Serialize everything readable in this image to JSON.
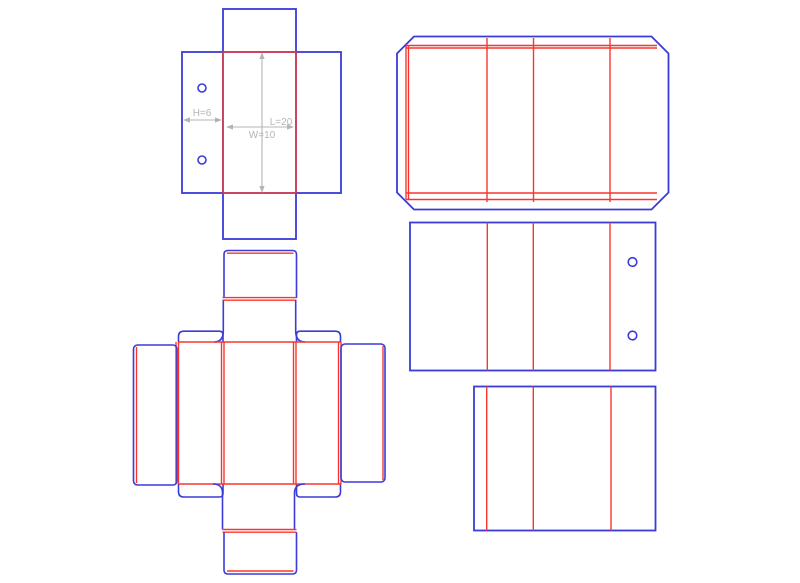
{
  "drawing": {
    "dimensions": {
      "height_label": "H=6",
      "length_label": "L=20",
      "width_label": "W=10"
    }
  },
  "colors": {
    "blue": "#3b3bd8",
    "red": "#f7372f",
    "gray": "#b4b4b4",
    "background": "#ffffff"
  }
}
